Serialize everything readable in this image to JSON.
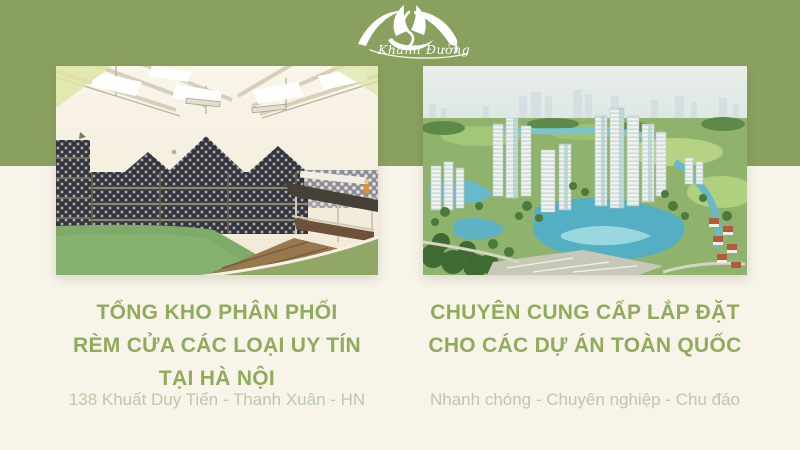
{
  "brand": {
    "name": "Khánh Đường",
    "icon": "lotus-icon"
  },
  "colors": {
    "header_band": "#8AA05E",
    "background": "#F8F4EA",
    "heading_text": "#8FAC5D",
    "subtitle_text": "#BDC8AA",
    "logo": "#FFFFFF",
    "photo_corner_swoosh": "#90A765"
  },
  "left_section": {
    "heading_lines": [
      "TỔNG KHO PHÂN PHỐI",
      "RÈM CỬA CÁC LOẠI UY TÍN",
      "TẠI HÀ NỘI"
    ],
    "subtitle": "138 Khuất Duy Tiến - Thanh Xuân - HN",
    "photo": "warehouse-curtain-rolls-photo"
  },
  "right_section": {
    "heading_lines": [
      "CHUYÊN CUNG CẤP LẮP ĐẶT",
      "CHO CÁC DỰ ÁN TOÀN QUỐC"
    ],
    "subtitle": "Nhanh chóng - Chuyên nghiệp - Chu đáo",
    "photo": "city-masterplan-aerial-photo"
  }
}
